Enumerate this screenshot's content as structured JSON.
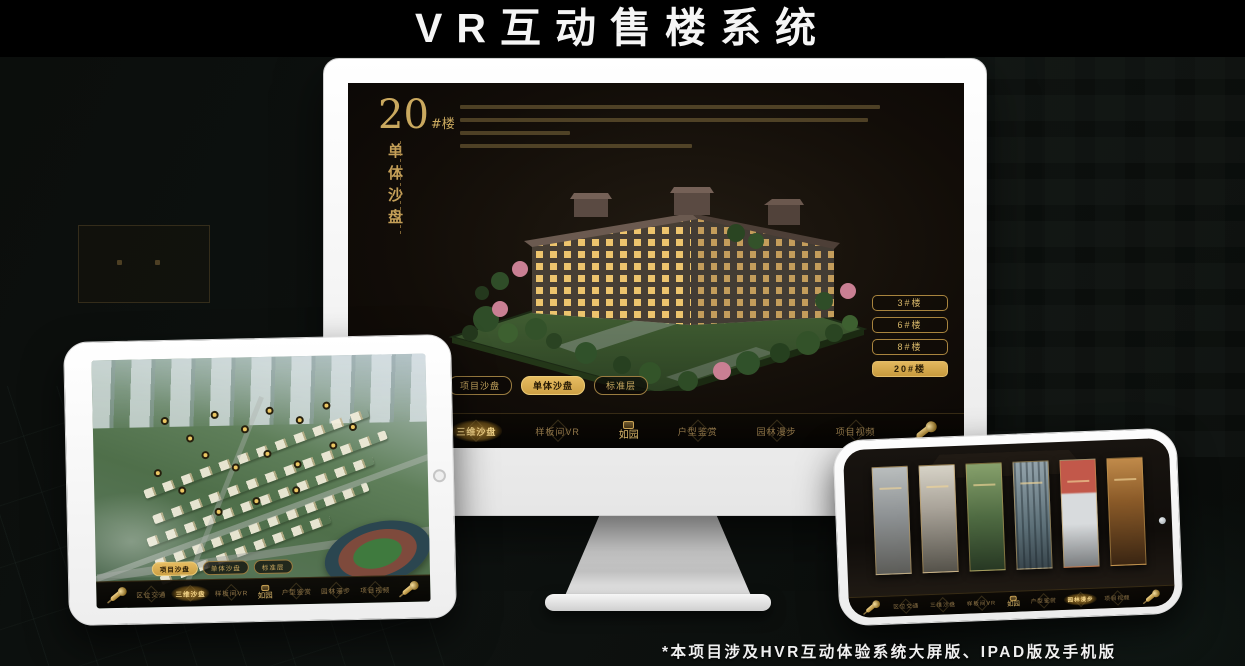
{
  "page": {
    "title": "VR互动售楼系统",
    "footnote": "*本项目涉及HVR互动体验系统大屏版、IPAD版及手机版"
  },
  "nav_menu": {
    "logo_text": "如园",
    "items": [
      "区位交通",
      "三维沙盘",
      "样板间VR",
      "户型鉴赏",
      "园林漫步",
      "项目视频"
    ]
  },
  "view_tabs": [
    "项目沙盘",
    "单体沙盘",
    "标准层"
  ],
  "monitor": {
    "floor_number": "20",
    "floor_suffix": "#楼",
    "section_title_vertical": "单体沙盘",
    "active_view_tab": "单体沙盘",
    "active_nav_item": "三维沙盘",
    "building_buttons": [
      {
        "label": "3#楼",
        "active": false
      },
      {
        "label": "6#楼",
        "active": false
      },
      {
        "label": "8#楼",
        "active": false
      },
      {
        "label": "20#楼",
        "active": true
      }
    ]
  },
  "tablet": {
    "active_view_tab": "项目沙盘",
    "active_nav_item": "三维沙盘"
  },
  "phone": {
    "active_nav_item": "园林漫步"
  },
  "colors": {
    "gold": "#d2a855",
    "gold_deep": "#9c7a2f",
    "active_pill_bg": "#d9ab54",
    "screen_bg": "#14100b",
    "title_fg": "#f5f5f5"
  }
}
